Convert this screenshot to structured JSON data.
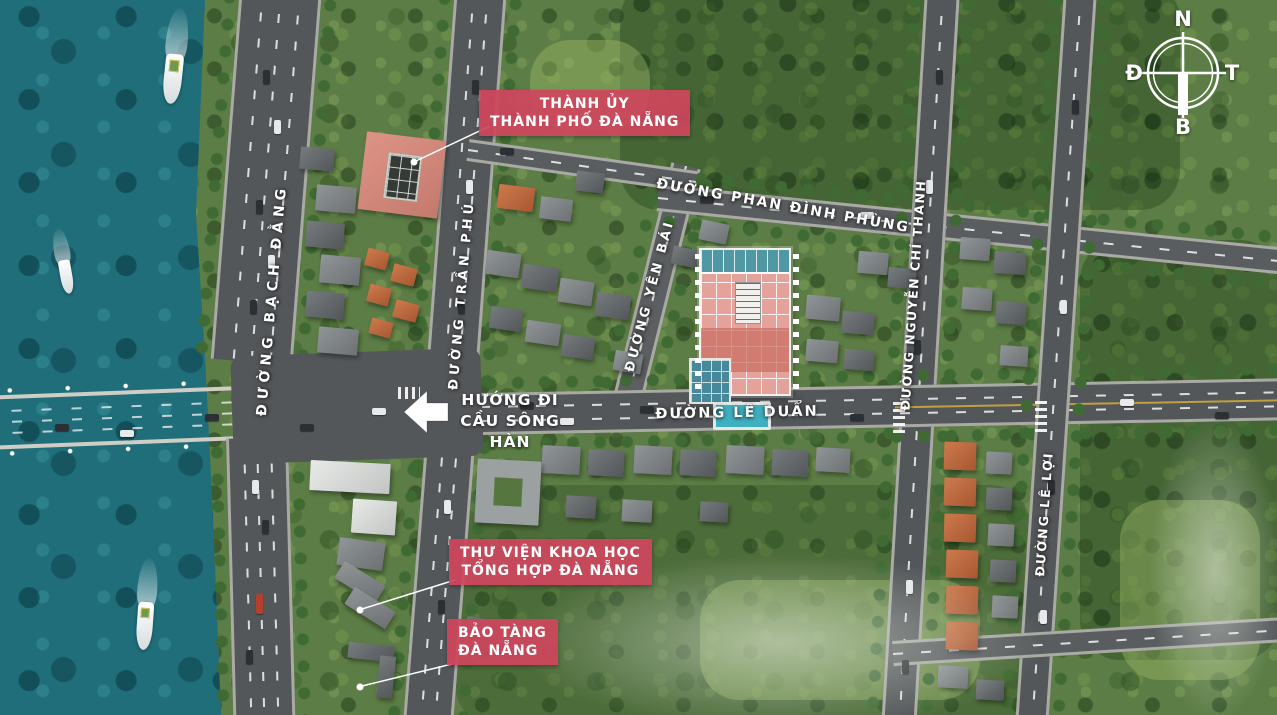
{
  "compass": {
    "top": "N",
    "right": "T",
    "bottom": "B",
    "left": "Đ"
  },
  "streets": [
    {
      "id": "bach-dang",
      "name": "ĐƯỜNG BẠCH ĐẰNG"
    },
    {
      "id": "tran-phu",
      "name": "ĐƯỜNG TRẦN PHÚ"
    },
    {
      "id": "yen-bai",
      "name": "ĐƯỜNG YÊN BÁI"
    },
    {
      "id": "phan-dinh-phung",
      "name": "ĐƯỜNG PHAN ĐÌNH PHÙNG"
    },
    {
      "id": "nguyen-chi-thanh",
      "name": "ĐƯỜNG NGUYỄN CHÍ THANH"
    },
    {
      "id": "le-duan",
      "name": "ĐƯỜNG LÊ DUẨN"
    },
    {
      "id": "le-loi",
      "name": "ĐƯỜNG LÊ LỢI"
    }
  ],
  "poi_labels": {
    "city_hall": {
      "line1": "THÀNH ỦY",
      "line2": "THÀNH PHỐ ĐÀ NẴNG"
    },
    "library": {
      "line1": "THƯ VIỆN KHOA HỌC",
      "line2": "TỔNG HỢP ĐÀ NẴNG"
    },
    "museum": {
      "line1": "BẢO TÀNG",
      "line2": "ĐÀ NẴNG"
    }
  },
  "direction_sign": {
    "line1": "HƯỚNG ĐI",
    "line2": "CẦU SÔNG HÀN"
  },
  "colors": {
    "label_red": "#cf465c",
    "water_teal": "#1f6e7a",
    "road_gray": "#54575a",
    "bridge_asphalt": "#6a655c",
    "project_pink": "#e5a29b",
    "project_teal": "#4f98a4",
    "terrain_green": "#5c7d45"
  }
}
